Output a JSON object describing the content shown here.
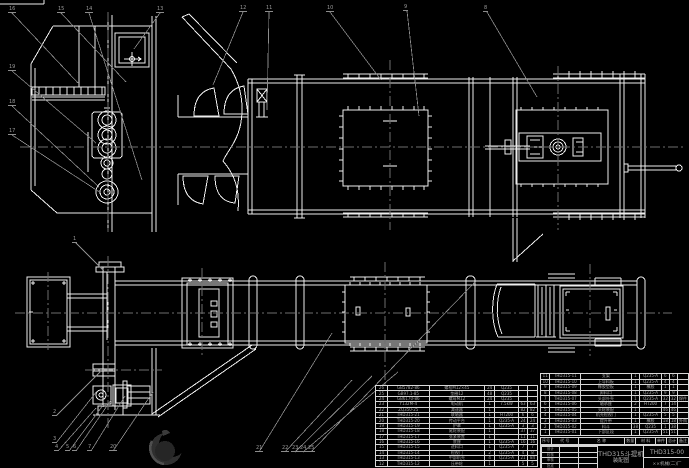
{
  "colors": {
    "background": "#000000",
    "line": "#ededed",
    "leader": "#8c8c8c",
    "centerline": "#6e6e6e",
    "table_text": "#a8a8a8",
    "logo": "#2f2f2f"
  },
  "title_block": {
    "product_line1": "THD315斗提机",
    "product_line2": "装配图",
    "drawing_number": "THD315-00",
    "company": "××机械(二)厂",
    "sign_rows": [
      [
        "设计",
        "",
        ""
      ],
      [
        "校核",
        "",
        ""
      ],
      [
        "审核",
        "",
        ""
      ],
      [
        "批准",
        "",
        ""
      ]
    ]
  },
  "bom_right": {
    "header": [
      "序号",
      "代 号",
      "名 称",
      "数量",
      "材 料",
      "单件",
      "总计",
      "备注"
    ],
    "rows": [
      [
        "11",
        "THD315-11",
        "支架",
        "1",
        "Q235-A",
        "6",
        "6",
        ""
      ],
      [
        "10",
        "THD315-10",
        "上导料板",
        "1",
        "Q235-A",
        "4",
        "4",
        ""
      ],
      [
        "9",
        "THD315-09",
        "橡胶垫板",
        "1",
        "橡胶",
        "1",
        "1",
        ""
      ],
      [
        "8",
        "THD315-08",
        "卸料口",
        "1",
        "Q235-A",
        "9",
        "9",
        ""
      ],
      [
        "7",
        "THD315-07",
        "头部外壳",
        "1",
        "Q235-A",
        "32",
        "32",
        "焊件"
      ],
      [
        "6",
        "THD315-06",
        "轴承座",
        "2",
        "HT200",
        "7",
        "14",
        ""
      ],
      [
        "5",
        "THD315-05",
        "头轮装配",
        "1",
        "",
        "46",
        "46",
        ""
      ],
      [
        "4",
        "THD315-04",
        "机壳检视门",
        "1",
        "Q235-A",
        "5",
        "5",
        ""
      ],
      [
        "3",
        "THD315-03",
        "提升带",
        "1",
        "橡胶",
        "18",
        "18",
        "外购"
      ],
      [
        "2",
        "THD315-02",
        "料斗",
        "38",
        "Q235",
        "1",
        "38",
        ""
      ],
      [
        "1",
        "THD315-01",
        "下部区段",
        "1",
        "Q235-A",
        "51",
        "51",
        ""
      ]
    ]
  },
  "bom_left": {
    "rows": [
      [
        "26",
        "GB5782-86",
        "螺栓M12×45",
        "24",
        "Q235",
        "",
        ""
      ],
      [
        "25",
        "GB97.1-85",
        "垫圈12",
        "48",
        "Q235",
        "",
        ""
      ],
      [
        "24",
        "GB6170-86",
        "螺母M12",
        "24",
        "Q235",
        "",
        ""
      ],
      [
        "23",
        "Y132M-4",
        "电动机",
        "1",
        "7.5kW",
        "63",
        "63"
      ],
      [
        "22",
        "ZQ350-25",
        "减速器",
        "1",
        "",
        "82",
        "82"
      ],
      [
        "21",
        "THD315-21",
        "联轴器",
        "1",
        "HT200",
        "6",
        "6"
      ],
      [
        "20",
        "THD315-20",
        "传动平台",
        "1",
        "Q235-A",
        "24",
        "24"
      ],
      [
        "19",
        "THD315-19",
        "护罩",
        "1",
        "Q235-A",
        "3",
        "3"
      ],
      [
        "18",
        "THD315-18",
        "尾轮装配",
        "1",
        "",
        "37",
        "37"
      ],
      [
        "17",
        "THD315-17",
        "张紧装置",
        "1",
        "",
        "11",
        "11"
      ],
      [
        "16",
        "THD315-16",
        "底座",
        "1",
        "Q235-A",
        "16",
        "16"
      ],
      [
        "15",
        "THD315-15",
        "进料口",
        "1",
        "Q235-A",
        "7",
        "7"
      ],
      [
        "14",
        "THD315-14",
        "检视门",
        "2",
        "Q235-A",
        "4",
        "8"
      ],
      [
        "13",
        "THD315-13",
        "中部机壳",
        "4",
        "Q235-A",
        "21",
        "84"
      ],
      [
        "12",
        "THD315-12",
        "压带轮",
        "1",
        "",
        "5",
        "5"
      ]
    ]
  },
  "balloons": [
    {
      "label": "16",
      "x": 8,
      "y": 6
    },
    {
      "label": "15",
      "x": 57,
      "y": 6
    },
    {
      "label": "14",
      "x": 85,
      "y": 6
    },
    {
      "label": "13",
      "x": 156,
      "y": 6
    },
    {
      "label": "12",
      "x": 239,
      "y": 5
    },
    {
      "label": "11",
      "x": 265,
      "y": 5
    },
    {
      "label": "10",
      "x": 326,
      "y": 5
    },
    {
      "label": "9",
      "x": 403,
      "y": 4
    },
    {
      "label": "8",
      "x": 483,
      "y": 5
    },
    {
      "label": "19",
      "x": 8,
      "y": 64
    },
    {
      "label": "18",
      "x": 8,
      "y": 99
    },
    {
      "label": "17",
      "x": 8,
      "y": 128
    },
    {
      "label": "1",
      "x": 72,
      "y": 236
    },
    {
      "label": "2",
      "x": 52,
      "y": 409
    },
    {
      "label": "3",
      "x": 52,
      "y": 436
    },
    {
      "label": "4",
      "x": 54,
      "y": 444
    },
    {
      "label": "5",
      "x": 65,
      "y": 444
    },
    {
      "label": "6",
      "x": 72,
      "y": 444
    },
    {
      "label": "7",
      "x": 87,
      "y": 444
    },
    {
      "label": "20",
      "x": 109,
      "y": 444
    },
    {
      "label": "21",
      "x": 255,
      "y": 445
    },
    {
      "label": "22",
      "x": 281,
      "y": 445
    },
    {
      "label": "23",
      "x": 291,
      "y": 445
    },
    {
      "label": "24",
      "x": 299,
      "y": 445
    },
    {
      "label": "25",
      "x": 307,
      "y": 445
    }
  ]
}
